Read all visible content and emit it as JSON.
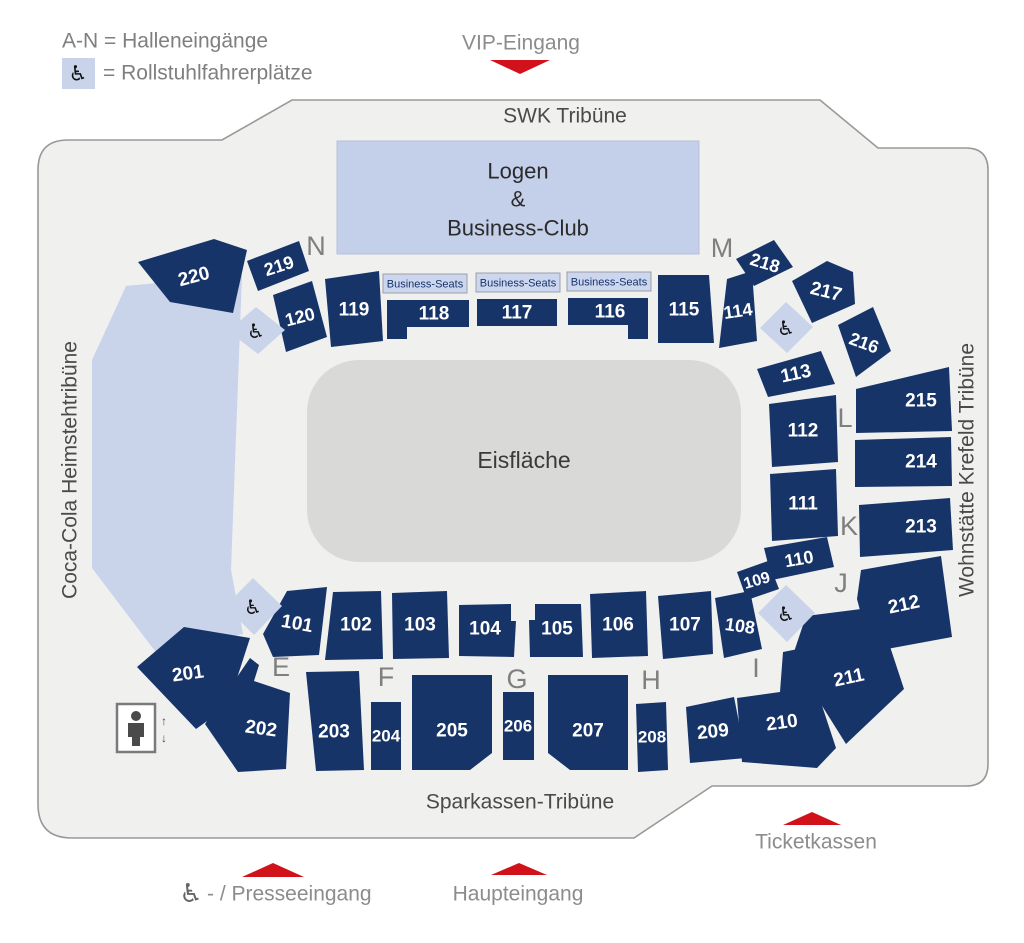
{
  "colors": {
    "navy": "#173469",
    "light_blue": "#C9D3EA",
    "logen_blue": "#C4CFE9",
    "biz_blue": "#CCD6EE",
    "arena_bg": "#F0F0EF",
    "outline": "#999999",
    "ice": "#D9D9D8",
    "red": "#D2121B",
    "gray_text": "#8C8C8C",
    "dark_text": "#4A4A4A",
    "letter_gray": "#7F7F7F",
    "section_text": "#FFFFFF",
    "icon_black": "#111111"
  },
  "icons": {
    "wheelchair": "♿",
    "arrow_up": "↑",
    "arrow_down": "↓"
  },
  "legend": {
    "line1": "A-N = Halleneingänge",
    "line2": "= Rollstuhlfahrerplätze",
    "x1": 62,
    "y1": 41,
    "box": {
      "x": 62,
      "y": 58,
      "w": 33,
      "h": 31
    },
    "icon_x": 78,
    "icon_y": 74,
    "x2": 103,
    "y2": 73
  },
  "entrances": {
    "vip": {
      "label": "VIP-Eingang",
      "tx": 521,
      "ty": 43,
      "tri": "490,60 550,60 520,74"
    },
    "presse": {
      "label": "- / Presseeingang",
      "tx": 207,
      "ty": 894,
      "icon_x": 191,
      "icon_y": 893,
      "tri": "242,877 304,877 273,863"
    },
    "haupt": {
      "label": "Haupteingang",
      "tx": 518,
      "ty": 894,
      "tri": "491,875 547,875 519,863"
    },
    "ticket": {
      "label": "Ticketkassen",
      "tx": 816,
      "ty": 842,
      "tri": "783,825 841,825 812,812"
    }
  },
  "tribunes": {
    "top": {
      "label": "SWK Tribüne",
      "x": 565,
      "y": 116,
      "rot": 0
    },
    "bottom": {
      "label": "Sparkassen-Tribüne",
      "x": 520,
      "y": 802,
      "rot": 0
    },
    "left": {
      "label": "Coca-Cola Heimstehtribüne",
      "x": 70,
      "y": 470,
      "rot": -90
    },
    "right": {
      "label": "Wohnstätte Krefeld Tribüne",
      "x": 967,
      "y": 470,
      "rot": -90
    }
  },
  "map": {
    "outline": "M 68,140 L 222,140 L 292,100 L 820,100 L 878,148 L 966,148 Q 988,148 988,170 L 988,764 Q 988,786 966,786 L 712,786 L 634,838 L 72,838 Q 38,838 38,804 L 38,170 Q 38,140 68,140 Z",
    "standing_area": "92,360 126,286 242,275 231,570 243,634 158,655 92,568",
    "ice": {
      "x": 307,
      "y": 360,
      "w": 434,
      "h": 202,
      "rx": 52,
      "label": "Eisfläche",
      "label_x": 524,
      "label_y": 460
    },
    "logen": {
      "x": 337,
      "y": 141,
      "w": 362,
      "h": 113,
      "lines": [
        "Logen",
        "&",
        "Business-Club"
      ],
      "cx": 518,
      "line_y": [
        171,
        199,
        228
      ]
    },
    "business_seats_label": "Business-Seats",
    "business_boxes": [
      {
        "x": 383,
        "y": 274,
        "w": 84,
        "h": 19
      },
      {
        "x": 476,
        "y": 273,
        "w": 84,
        "h": 19
      },
      {
        "x": 567,
        "y": 272,
        "w": 84,
        "h": 19
      }
    ],
    "sections": [
      {
        "id": "220",
        "pts": "138,262 214,239 247,250 233,313 170,302",
        "lx": 194,
        "ly": 277,
        "rot": -15
      },
      {
        "id": "219",
        "pts": "247,261 299,241 309,271 258,291",
        "lx": 279,
        "ly": 266,
        "rot": -18,
        "fs": 18
      },
      {
        "id": "218",
        "pts": "736,259 774,240 793,267 754,286",
        "lx": 765,
        "ly": 263,
        "rot": 17,
        "fs": 18
      },
      {
        "id": "217",
        "pts": "792,281 827,261 853,272 855,304 812,323",
        "lx": 826,
        "ly": 292,
        "rot": 14
      },
      {
        "id": "216",
        "pts": "838,325 873,307 891,351 856,377",
        "lx": 864,
        "ly": 343,
        "rot": 20,
        "fs": 18
      },
      {
        "id": "215",
        "pts": "856,389 949,367 952,431 856,433",
        "lx": 921,
        "ly": 401
      },
      {
        "id": "214",
        "pts": "855,440 951,437 952,486 855,487",
        "lx": 921,
        "ly": 462
      },
      {
        "id": "213",
        "pts": "859,505 950,498 953,550 860,557",
        "lx": 921,
        "ly": 527
      },
      {
        "id": "212",
        "pts": "861,570 941,556 952,637 871,652 857,599",
        "lx": 904,
        "ly": 605,
        "rot": -12
      },
      {
        "id": "211",
        "pts": "806,616 877,607 904,689 846,744 792,658",
        "lx": 849,
        "ly": 678,
        "rot": -12
      },
      {
        "id": "210",
        "pts": "737,698 780,692 783,652 803,648 836,748 817,768 742,762",
        "lx": 782,
        "ly": 723,
        "rot": -8
      },
      {
        "id": "209",
        "pts": "686,707 734,697 746,758 690,763",
        "lx": 713,
        "ly": 732,
        "rot": -6
      },
      {
        "id": "208",
        "pts": "636,704 666,702 668,770 638,772",
        "lx": 652,
        "ly": 737,
        "fs": 17
      },
      {
        "id": "207",
        "pts": "548,675 628,675 628,770 570,770 548,753",
        "lx": 588,
        "ly": 731
      },
      {
        "id": "206",
        "pts": "503,692 534,692 534,760 503,760",
        "lx": 518,
        "ly": 726,
        "fs": 17
      },
      {
        "id": "205",
        "pts": "412,675 492,675 492,753 470,770 412,770",
        "lx": 452,
        "ly": 731
      },
      {
        "id": "204",
        "pts": "371,702 401,702 401,770 371,770",
        "lx": 386,
        "ly": 736,
        "fs": 17
      },
      {
        "id": "203",
        "pts": "306,672 359,671 364,770 316,771",
        "lx": 334,
        "ly": 732
      },
      {
        "id": "202",
        "pts": "205,724 250,658 259,665 254,681 290,693 286,769 238,772",
        "lx": 261,
        "ly": 729,
        "rot": 8
      },
      {
        "id": "201",
        "pts": "137,667 184,627 250,638 228,706 196,729",
        "lx": 188,
        "ly": 674,
        "rot": -8
      },
      {
        "id": "120",
        "pts": "273,295 312,281 327,337 286,352",
        "lx": 300,
        "ly": 317,
        "rot": -14,
        "fs": 18
      },
      {
        "id": "119",
        "pts": "325,279 379,271 383,341 331,347",
        "lx": 354,
        "ly": 310
      },
      {
        "id": "118",
        "pts": "387,300 469,300 469,327 407,327 407,339 387,339",
        "lx": 434,
        "ly": 314
      },
      {
        "id": "117",
        "pts": "477,299 557,299 557,326 477,326",
        "lx": 517,
        "ly": 313
      },
      {
        "id": "116",
        "pts": "568,298 648,298 648,339 628,339 628,325 568,325",
        "lx": 610,
        "ly": 312
      },
      {
        "id": "115",
        "pts": "658,275 709,275 714,343 658,343",
        "lx": 684,
        "ly": 310
      },
      {
        "id": "114",
        "pts": "727,279 752,271 757,341 719,348",
        "lx": 738,
        "ly": 311,
        "rot": -8,
        "fs": 18
      },
      {
        "id": "113",
        "pts": "757,369 821,351 835,384 768,397",
        "lx": 796,
        "ly": 374,
        "rot": -12
      },
      {
        "id": "112",
        "pts": "769,404 836,395 838,462 772,467",
        "lx": 803,
        "ly": 431
      },
      {
        "id": "111",
        "pts": "770,474 836,469 838,536 772,541",
        "lx": 803,
        "ly": 504
      },
      {
        "id": "110",
        "pts": "764,548 827,537 834,567 772,580",
        "lx": 799,
        "ly": 559,
        "rot": -10,
        "fs": 18
      },
      {
        "id": "109",
        "pts": "737,572 768,561 779,589 747,600",
        "lx": 757,
        "ly": 581,
        "rot": -16,
        "fs": 16
      },
      {
        "id": "108",
        "pts": "715,598 750,591 762,649 724,658",
        "lx": 740,
        "ly": 626,
        "rot": 8,
        "fs": 18
      },
      {
        "id": "107",
        "pts": "658,596 711,591 713,654 663,659",
        "lx": 685,
        "ly": 625
      },
      {
        "id": "106",
        "pts": "590,594 646,591 648,656 592,658",
        "lx": 618,
        "ly": 625
      },
      {
        "id": "105",
        "pts": "529,620 535,620 535,604 581,604 583,657 530,657",
        "lx": 557,
        "ly": 629
      },
      {
        "id": "104",
        "pts": "459,605 511,604 511,621 516,621 514,657 459,656",
        "lx": 485,
        "ly": 629
      },
      {
        "id": "103",
        "pts": "392,593 447,591 449,658 393,659",
        "lx": 420,
        "ly": 625
      },
      {
        "id": "102",
        "pts": "333,592 381,591 383,659 325,660",
        "lx": 356,
        "ly": 625
      },
      {
        "id": "101",
        "pts": "287,591 327,587 319,655 273,657 263,634",
        "lx": 297,
        "ly": 624,
        "rot": 10
      }
    ],
    "gate_letters": [
      {
        "t": "N",
        "x": 316,
        "y": 246
      },
      {
        "t": "M",
        "x": 722,
        "y": 248
      },
      {
        "t": "E",
        "x": 281,
        "y": 667
      },
      {
        "t": "F",
        "x": 386,
        "y": 677
      },
      {
        "t": "G",
        "x": 517,
        "y": 679
      },
      {
        "t": "H",
        "x": 651,
        "y": 680
      },
      {
        "t": "I",
        "x": 756,
        "y": 668
      },
      {
        "t": "J",
        "x": 841,
        "y": 583
      },
      {
        "t": "K",
        "x": 849,
        "y": 526
      },
      {
        "t": "L",
        "x": 845,
        "y": 418
      }
    ],
    "wheelchair_zones": [
      {
        "pts": "256,307 285,330 258,354 228,331",
        "ix": 256,
        "iy": 332
      },
      {
        "pts": "786,302 813,327 787,353 760,328",
        "ix": 786,
        "iy": 329
      },
      {
        "pts": "253,578 282,606 254,635 225,606",
        "ix": 253,
        "iy": 608
      },
      {
        "pts": "786,585 815,613 787,642 758,613",
        "ix": 786,
        "iy": 615
      }
    ],
    "elevator": {
      "x": 117,
      "y": 704,
      "w": 38,
      "h": 48,
      "up_x": 164,
      "up_y": 721,
      "down_x": 164,
      "down_y": 738
    }
  }
}
